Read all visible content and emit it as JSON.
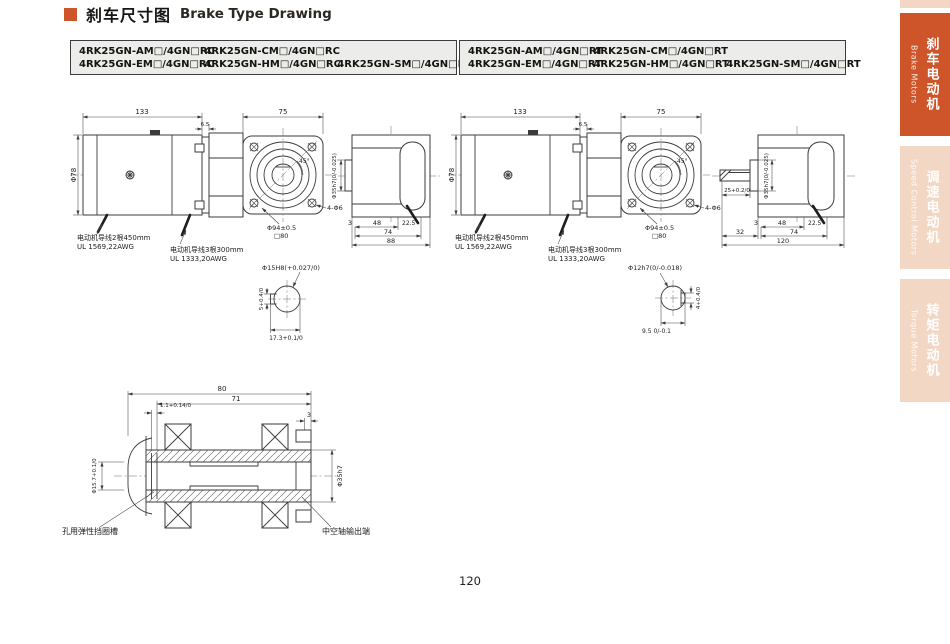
{
  "page": {
    "title_zh": "刹车尺寸图",
    "title_en": "Brake Type Drawing",
    "page_number": "120"
  },
  "colors": {
    "accent_orange": "#CE5429",
    "tab_inactive_pink": "#F3D7C5",
    "model_box_bg": "#ECECEA"
  },
  "models": {
    "left": [
      "4RK25GN-AM□/4GN□RC",
      "4RK25GN-CM□/4GN□RC",
      "",
      "4RK25GN-EM□/4GN□RC",
      "4RK25GN-HM□/4GN□RC",
      "4RK25GN-SM□/4GN□RC"
    ],
    "right": [
      "4RK25GN-AM□/4GN□RT",
      "4RK25GN-CM□/4GN□RT",
      "",
      "4RK25GN-EM□/4GN□RT",
      "4RK25GN-HM□/4GN□RT",
      "4RK25GN-SM□/4GN□RT"
    ]
  },
  "dims": {
    "d133": "133",
    "d6_5": "6.5",
    "d75": "75",
    "phi78": "Φ78",
    "a45": "45°",
    "phi94": "Φ94±0.5",
    "sq80": "□80",
    "holes4": "4-Φ6",
    "d3": "3",
    "d48": "48",
    "a22_5": "22.5°",
    "d74": "74",
    "d88": "88",
    "d32": "32",
    "d120": "120",
    "d25": "25+0.2/0",
    "shaft35": "Φ35h7(0/-0.025)"
  },
  "wires": {
    "lead2": "电动机导线2根450mm",
    "lead2_spec": "UL 1569,22AWG",
    "lead3": "电动机导线3根300mm",
    "lead3_spec": "UL 1333,20AWG"
  },
  "detail_bore": {
    "dia": "Φ15H8(+0.027/0)",
    "key_width": "5+0.4/0",
    "key_depth": "17.3+0.1/0"
  },
  "detail_shaft": {
    "dia": "Φ12h7(0/-0.018)",
    "key_width": "4+0.4/0",
    "flat": "9.5 0/-0.1"
  },
  "hollow": {
    "d80": "80",
    "d71": "71",
    "groove_width": "1.1+0.14/0",
    "d3": "3",
    "groove_dia": "Φ15.7+0.1/0",
    "od": "Φ35h7",
    "label_groove": "孔用弹性挡圈槽",
    "label_output": "中空轴输出端"
  },
  "sidebar": {
    "tabs": [
      {
        "zh": "刹车电动机",
        "en": "Brake Motors",
        "active": true
      },
      {
        "zh": "调速电动机",
        "en": "Speed Control Motors",
        "active": false
      },
      {
        "zh": "转矩电动机",
        "en": "Torque Motors",
        "active": false
      }
    ]
  }
}
